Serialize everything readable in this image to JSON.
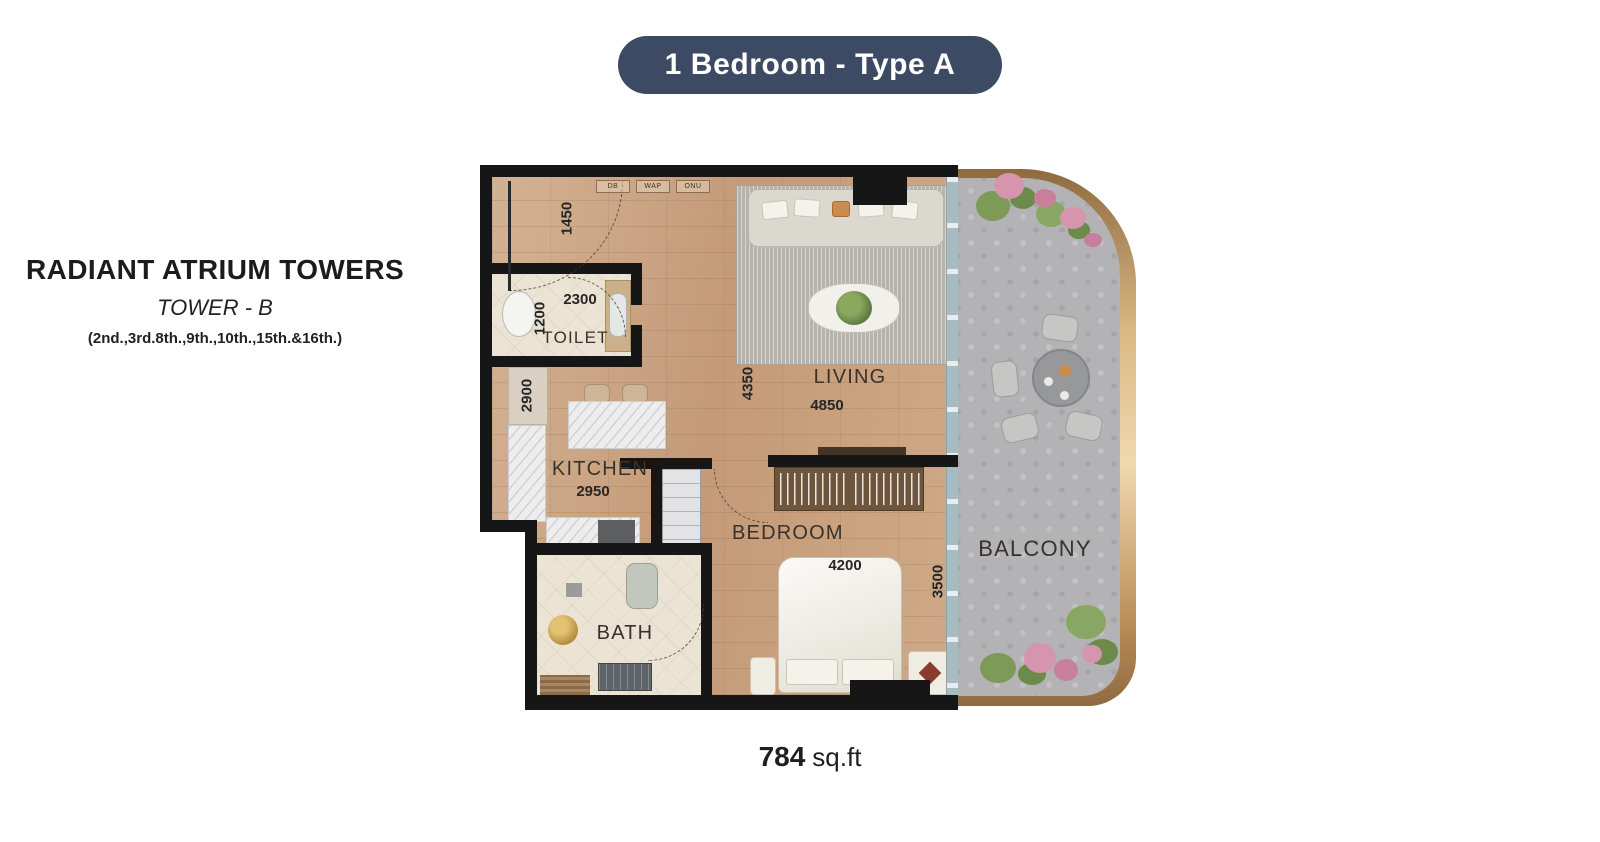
{
  "badge": {
    "label": "1 Bedroom - Type A"
  },
  "project": {
    "name": "RADIANT ATRIUM TOWERS",
    "tower": "TOWER - B",
    "floors": "(2nd.,3rd.8th.,9th.,10th.,15th.&16th.)"
  },
  "area": {
    "value": "784",
    "unit": "sq.ft"
  },
  "plan": {
    "entry": {
      "width": "1450"
    },
    "utilities": [
      "DB",
      "WAP",
      "ONU"
    ],
    "rooms": {
      "toilet": {
        "label": "TOILET",
        "width": "2300",
        "depth": "1200"
      },
      "kitchen": {
        "label": "KITCHEN",
        "width": "2950",
        "depth": "2900"
      },
      "living": {
        "label": "LIVING",
        "width": "4850",
        "depth": "4350"
      },
      "bedroom": {
        "label": "BEDROOM",
        "width": "4200",
        "depth": "3500"
      },
      "bath": {
        "label": "BATH"
      },
      "balcony": {
        "label": "BALCONY"
      }
    }
  },
  "colors": {
    "badge-bg": "#3d4a63",
    "badge-text": "#ffffff",
    "wall": "#161616",
    "ink": "#1f1f1f",
    "balcony-floor": "#b3b2b4"
  }
}
